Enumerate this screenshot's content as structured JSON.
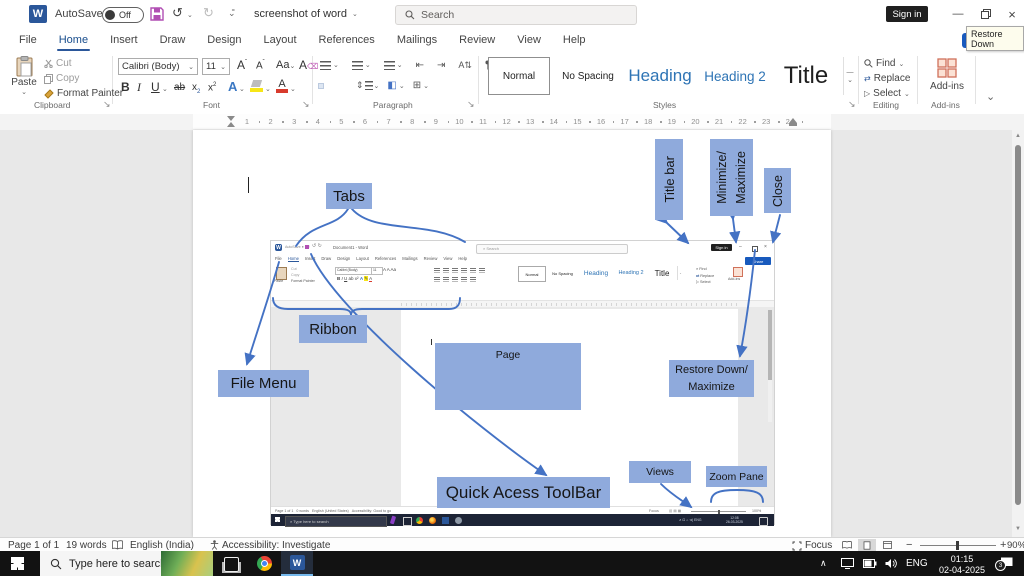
{
  "titlebar": {
    "autosave_label": "AutoSave",
    "autosave_state": "Off",
    "document_title": "screenshot of word",
    "search_placeholder": "Search",
    "sign_in": "Sign in",
    "restore_tooltip": "Restore Down",
    "share": "Share"
  },
  "tabs": [
    "File",
    "Home",
    "Insert",
    "Draw",
    "Design",
    "Layout",
    "References",
    "Mailings",
    "Review",
    "View",
    "Help"
  ],
  "ribbon": {
    "clipboard": {
      "label": "Clipboard",
      "paste": "Paste",
      "cut": "Cut",
      "copy": "Copy",
      "format_painter": "Format Painter"
    },
    "font": {
      "label": "Font",
      "family": "Calibri (Body)",
      "size": "11"
    },
    "paragraph": {
      "label": "Paragraph"
    },
    "styles": {
      "label": "Styles",
      "items": [
        "Normal",
        "No Spacing",
        "Heading",
        "Heading 2",
        "Title"
      ]
    },
    "editing": {
      "label": "Editing",
      "find": "Find",
      "replace": "Replace",
      "select": "Select"
    },
    "addins": {
      "label": "Add-ins",
      "button": "Add-ins"
    }
  },
  "ruler": {
    "numbers": [
      1,
      2,
      3,
      4,
      5,
      6,
      7,
      8,
      9,
      10,
      11,
      12,
      13,
      14,
      15,
      16,
      17,
      18,
      19,
      20,
      21,
      22,
      23,
      24
    ]
  },
  "document": {
    "annotations": {
      "tabs": "Tabs",
      "title_bar": "Title bar",
      "minimize_line1": "Minimize/",
      "minimize_line2": "Maximize",
      "close": "Close",
      "ribbon": "Ribbon",
      "file_menu": "File Menu",
      "page": "Page",
      "quick_access": "Quick Acess ToolBar",
      "restore_line1": "Restore Down/",
      "restore_line2": "Maximize",
      "views": "Views",
      "zoom_pane": "Zoom Pane"
    }
  },
  "mini_window": {
    "title": "Document1 - Word",
    "autosave": "AutoSave",
    "autosave_state": "Off",
    "search": "Search",
    "sign_in": "Sign in",
    "share": "Share",
    "status": {
      "page": "Page 1 of 1",
      "words": "0 words",
      "language": "English (United States)",
      "accessibility": "Accessibility: Good to go",
      "focus": "Focus",
      "zoom": "100%"
    },
    "taskbar": {
      "search": "Type here to search",
      "time": "12:08",
      "date": "26-03-2025",
      "language": "ENG"
    }
  },
  "status_bar": {
    "page": "Page 1 of 1",
    "words": "19 words",
    "language": "English (India)",
    "accessibility": "Accessibility: Investigate",
    "focus": "Focus",
    "zoom": "90%"
  },
  "taskbar": {
    "search": "Type here to search",
    "language": "ENG",
    "time": "01:15",
    "date": "02-04-2025",
    "notifications": "3"
  },
  "colors": {
    "callout_fill": "#8faadc",
    "arrow_blue": "#4472c4",
    "word_accent": "#2b579a",
    "share_button": "#185abd",
    "heading_blue": "#2e74b5"
  }
}
